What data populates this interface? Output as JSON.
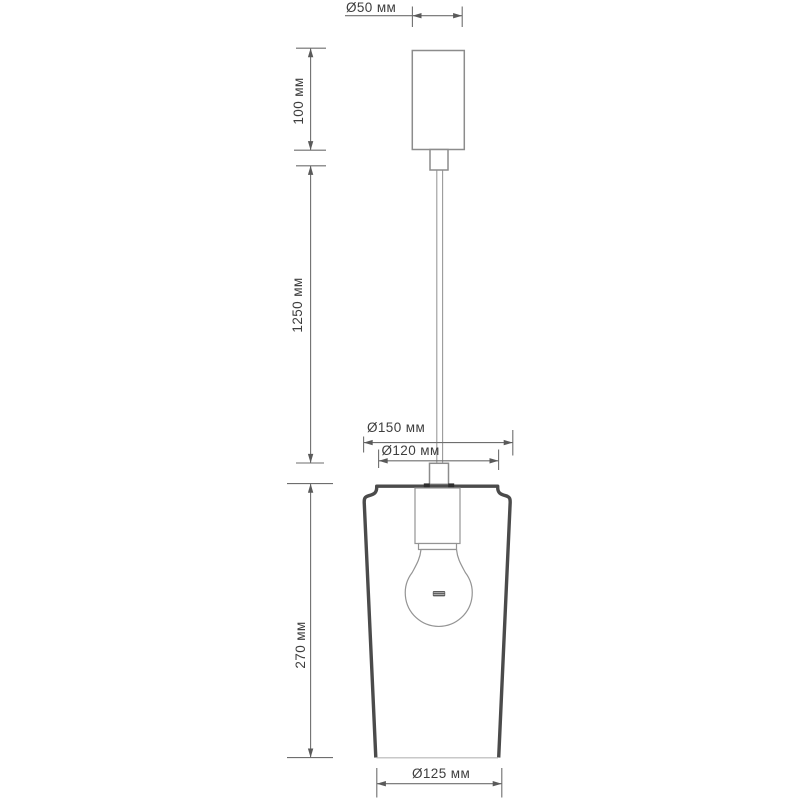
{
  "drawing": {
    "kind": "pendant-lamp-dimension-drawing",
    "labels": {
      "canopy_diameter": "Ø50 мм",
      "canopy_height": "100 мм",
      "cable_length": "1250 мм",
      "shade_top_diameter": "Ø150 мм",
      "shade_neck_diameter": "Ø120 мм",
      "shade_height": "270 мм",
      "shade_bottom_diameter": "Ø125 мм"
    },
    "dimensions_mm": {
      "canopy_diameter": 50,
      "canopy_height": 100,
      "cable_length": 1250,
      "shade_top_diameter": 150,
      "shade_neck_diameter": 120,
      "shade_height": 270,
      "shade_bottom_diameter": 125
    },
    "units": "мм",
    "colors": {
      "background": "#ffffff",
      "thin_line": "#8c8c8c",
      "dimension_line": "#6e6e6e",
      "thick_outline": "#4b4b4b",
      "text": "#3e3e3e"
    }
  }
}
